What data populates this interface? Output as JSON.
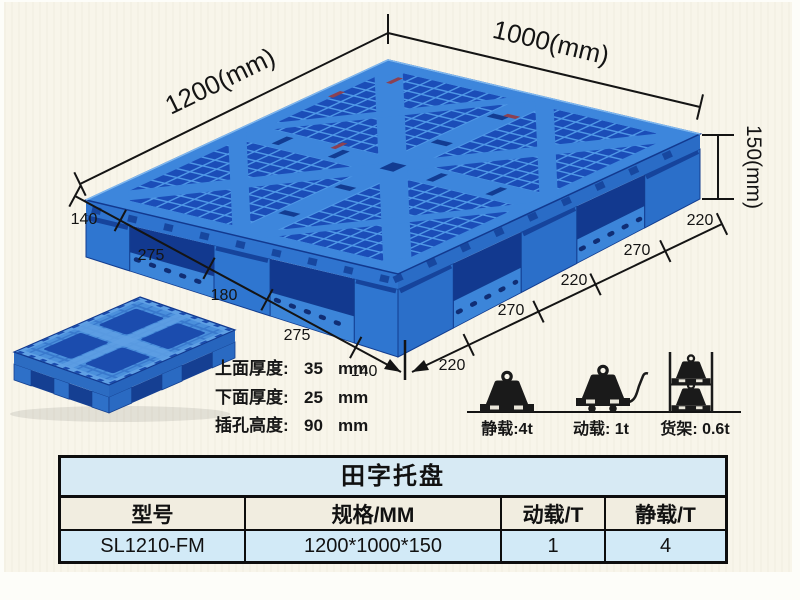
{
  "colors": {
    "background": "#f8f5ea",
    "pallet_blue": "#3d86dc",
    "pallet_light": "#4f98e6",
    "pallet_dark": "#1b4db8",
    "pallet_shadow": "#12398f",
    "line_color": "#141414",
    "table_title_bg": "#d7eaf4",
    "table_header_bg": "#f1ede0",
    "table_row_bg": "#d2eaf7"
  },
  "diagram": {
    "dims": {
      "length": "1200(mm)",
      "width": "1000(mm)",
      "height": "150(mm)"
    },
    "left_chain": [
      "140",
      "275",
      "180",
      "275",
      "140"
    ],
    "right_chain": [
      "220",
      "270",
      "220",
      "270",
      "220"
    ],
    "specs": [
      {
        "label": "上面厚度:",
        "value": "35",
        "unit": "mm"
      },
      {
        "label": "下面厚度:",
        "value": "25",
        "unit": "mm"
      },
      {
        "label": "插孔高度:",
        "value": "90",
        "unit": "mm"
      }
    ],
    "loads": [
      {
        "name": "static-load",
        "label": "静载:4t"
      },
      {
        "name": "dynamic-load",
        "label": "动载: 1t"
      },
      {
        "name": "rack-load",
        "label": "货架: 0.6t"
      }
    ]
  },
  "table": {
    "title": "田字托盘",
    "headers": [
      "型号",
      "规格/MM",
      "动载/T",
      "静载/T"
    ],
    "rows": [
      [
        "SL1210-FM",
        "1200*1000*150",
        "1",
        "4"
      ]
    ]
  }
}
